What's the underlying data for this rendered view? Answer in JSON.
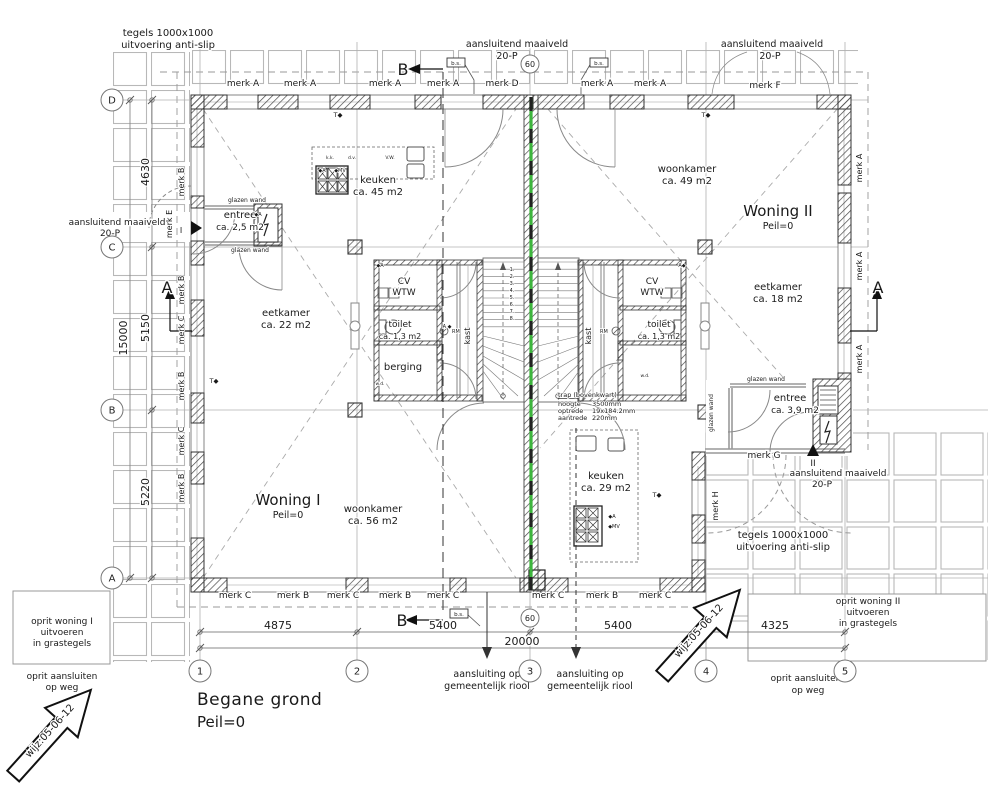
{
  "drawing": {
    "title": "Begane grond",
    "subtitle": "Peil=0"
  },
  "colors": {
    "text": "#1a1a1a",
    "wall": "#555555",
    "hatch": "#4a4a4a",
    "grid": "#b0b0b0",
    "tile": "#b8b8b8",
    "dash": "#999999",
    "green": "#3db53d",
    "thin": "#777777"
  },
  "grid": {
    "columns": [
      {
        "label": "1",
        "x": 200
      },
      {
        "label": "2",
        "x": 357
      },
      {
        "label": "3",
        "x": 530
      },
      {
        "label": "4",
        "x": 706
      },
      {
        "label": "5",
        "x": 845
      }
    ],
    "columns_y": 671,
    "rows": [
      {
        "label": "D",
        "y": 100
      },
      {
        "label": "C",
        "y": 247
      },
      {
        "label": "B",
        "y": 410
      },
      {
        "label": "A",
        "y": 578
      }
    ],
    "rows_x": 112,
    "small_bubbles": [
      {
        "label": "60",
        "x": 530,
        "y": 64
      },
      {
        "label": "60",
        "x": 530,
        "y": 618
      }
    ],
    "bs_tags": [
      {
        "label": "b.s.",
        "x": 456,
        "y": 63
      },
      {
        "label": "b.s.",
        "x": 599,
        "y": 63
      },
      {
        "label": "b.s.",
        "x": 459,
        "y": 614
      }
    ]
  },
  "dimensions": {
    "bottom": [
      {
        "t": "4875",
        "x": 278,
        "y": 629
      },
      {
        "t": "5400",
        "x": 443,
        "y": 629
      },
      {
        "t": "5400",
        "x": 618,
        "y": 629
      },
      {
        "t": "4325",
        "x": 775,
        "y": 629
      }
    ],
    "bottom_total": {
      "t": "20000",
      "x": 522,
      "y": 645
    },
    "left": [
      {
        "t": "4630",
        "x": 149,
        "y": 172
      },
      {
        "t": "5150",
        "x": 149,
        "y": 328
      },
      {
        "t": "5220",
        "x": 149,
        "y": 492
      }
    ],
    "left_total": {
      "t": "15000",
      "x": 127,
      "y": 338
    }
  },
  "annotations": [
    {
      "t": "tegels 1000x1000",
      "x": 168,
      "y": 36,
      "s": 10
    },
    {
      "t": "uitvoering anti-slip",
      "x": 168,
      "y": 48,
      "s": 10
    },
    {
      "t": "aansluitend maaiveld",
      "x": 517,
      "y": 47,
      "s": 9.5
    },
    {
      "t": "20-P",
      "x": 507,
      "y": 59,
      "s": 9.5
    },
    {
      "t": "aansluitend maaiveld",
      "x": 772,
      "y": 47,
      "s": 9.5
    },
    {
      "t": "20-P",
      "x": 770,
      "y": 59,
      "s": 9.5
    },
    {
      "t": "B",
      "x": 403,
      "y": 75,
      "s": 16
    },
    {
      "t": "B",
      "x": 402,
      "y": 626,
      "s": 16
    },
    {
      "t": "A",
      "x": 167,
      "y": 293,
      "s": 16
    },
    {
      "t": "A",
      "x": 878,
      "y": 293,
      "s": 16
    },
    {
      "t": "merk A",
      "x": 243,
      "y": 86,
      "s": 9
    },
    {
      "t": "merk A",
      "x": 300,
      "y": 86,
      "s": 9
    },
    {
      "t": "merk A",
      "x": 385,
      "y": 86,
      "s": 9
    },
    {
      "t": "merk A",
      "x": 443,
      "y": 86,
      "s": 9
    },
    {
      "t": "merk D",
      "x": 502,
      "y": 86,
      "s": 9
    },
    {
      "t": "merk A",
      "x": 597,
      "y": 86,
      "s": 9
    },
    {
      "t": "merk A",
      "x": 650,
      "y": 86,
      "s": 9
    },
    {
      "t": "merk F",
      "x": 765,
      "y": 88,
      "s": 9
    },
    {
      "t": "T◆",
      "x": 338,
      "y": 117,
      "s": 6.5
    },
    {
      "t": "T◆",
      "x": 706,
      "y": 117,
      "s": 6.5
    },
    {
      "t": "T◆",
      "x": 214,
      "y": 383,
      "s": 6.5
    },
    {
      "t": "T◆",
      "x": 657,
      "y": 497,
      "s": 6.5
    },
    {
      "t": "woonkamer",
      "x": 687,
      "y": 172,
      "s": 10
    },
    {
      "t": "ca. 49 m2",
      "x": 687,
      "y": 184,
      "s": 10
    },
    {
      "t": "keuken",
      "x": 378,
      "y": 183,
      "s": 10
    },
    {
      "t": "ca. 45 m2",
      "x": 378,
      "y": 195,
      "s": 10
    },
    {
      "t": "Woning II",
      "x": 778,
      "y": 216,
      "s": 15
    },
    {
      "t": "Peil=0",
      "x": 778,
      "y": 229,
      "s": 9.5
    },
    {
      "t": "Woning I",
      "x": 288,
      "y": 505,
      "s": 15
    },
    {
      "t": "Peil=0",
      "x": 288,
      "y": 518,
      "s": 9.5
    },
    {
      "t": "aansluitend maaiveld",
      "x": 117,
      "y": 225,
      "s": 9
    },
    {
      "t": "20-P",
      "x": 110,
      "y": 236,
      "s": 9
    },
    {
      "t": "merk E",
      "x": 172,
      "y": 224,
      "s": 8,
      "r": -90
    },
    {
      "t": "I",
      "x": 181,
      "y": 233,
      "s": 8
    },
    {
      "t": "glazen wand",
      "x": 247,
      "y": 202,
      "s": 6
    },
    {
      "t": "glazen wand",
      "x": 250,
      "y": 252,
      "s": 6
    },
    {
      "t": "entree",
      "x": 240,
      "y": 218,
      "s": 10
    },
    {
      "t": "ca. 2,5 m2",
      "x": 240,
      "y": 230,
      "s": 9
    },
    {
      "t": "merk B",
      "x": 184,
      "y": 182,
      "s": 8,
      "r": -90
    },
    {
      "t": "merk B",
      "x": 184,
      "y": 290,
      "s": 8,
      "r": -90
    },
    {
      "t": "merk C",
      "x": 184,
      "y": 330,
      "s": 8,
      "r": -90
    },
    {
      "t": "merk B",
      "x": 184,
      "y": 386,
      "s": 8,
      "r": -90
    },
    {
      "t": "merk C",
      "x": 184,
      "y": 441,
      "s": 8,
      "r": -90
    },
    {
      "t": "merk B",
      "x": 184,
      "y": 488,
      "s": 8,
      "r": -90
    },
    {
      "t": "eetkamer",
      "x": 286,
      "y": 316,
      "s": 10
    },
    {
      "t": "ca. 22 m2",
      "x": 286,
      "y": 328,
      "s": 10
    },
    {
      "t": "CV",
      "x": 404,
      "y": 284,
      "s": 9
    },
    {
      "t": "WTW",
      "x": 404,
      "y": 295,
      "s": 9
    },
    {
      "t": "toilet",
      "x": 400,
      "y": 327,
      "s": 9
    },
    {
      "t": "ca. 1,3 m2",
      "x": 400,
      "y": 339,
      "s": 8
    },
    {
      "t": "berging",
      "x": 403,
      "y": 370,
      "s": 10
    },
    {
      "t": "kast",
      "x": 470,
      "y": 336,
      "s": 8,
      "r": -90
    },
    {
      "t": "kast",
      "x": 591,
      "y": 336,
      "s": 8,
      "r": -90
    },
    {
      "t": "CV",
      "x": 652,
      "y": 284,
      "s": 9
    },
    {
      "t": "WTW",
      "x": 652,
      "y": 295,
      "s": 9
    },
    {
      "t": "toilet",
      "x": 659,
      "y": 327,
      "s": 9
    },
    {
      "t": "ca. 1,3 m2",
      "x": 659,
      "y": 339,
      "s": 8
    },
    {
      "t": "RM",
      "x": 452,
      "y": 333,
      "s": 5,
      "a": "start"
    },
    {
      "t": "RM",
      "x": 600,
      "y": 333,
      "s": 5,
      "a": "start"
    },
    {
      "t": "1.",
      "x": 512,
      "y": 271,
      "s": 5
    },
    {
      "t": "2.",
      "x": 512,
      "y": 278,
      "s": 5
    },
    {
      "t": "3.",
      "x": 512,
      "y": 285,
      "s": 5
    },
    {
      "t": "4.",
      "x": 512,
      "y": 292,
      "s": 5
    },
    {
      "t": "5.",
      "x": 512,
      "y": 299,
      "s": 5
    },
    {
      "t": "6.",
      "x": 512,
      "y": 306,
      "s": 5
    },
    {
      "t": "7.",
      "x": 512,
      "y": 313,
      "s": 5
    },
    {
      "t": "8.",
      "x": 512,
      "y": 320,
      "s": 5
    },
    {
      "t": "trap (bovenkwart)",
      "x": 558,
      "y": 397,
      "s": 6.5,
      "a": "start"
    },
    {
      "t": "hoogte",
      "x": 558,
      "y": 406,
      "s": 6.5,
      "a": "start"
    },
    {
      "t": "3500mm",
      "x": 592,
      "y": 406,
      "s": 6.5,
      "a": "start"
    },
    {
      "t": "optrede",
      "x": 558,
      "y": 413,
      "s": 6.5,
      "a": "start"
    },
    {
      "t": "19x184.2mm",
      "x": 592,
      "y": 413,
      "s": 6.5,
      "a": "start"
    },
    {
      "t": "aantrede",
      "x": 558,
      "y": 420,
      "s": 6.5,
      "a": "start"
    },
    {
      "t": "220mm",
      "x": 592,
      "y": 420,
      "s": 6.5,
      "a": "start"
    },
    {
      "t": "eetkamer",
      "x": 778,
      "y": 290,
      "s": 10
    },
    {
      "t": "ca. 18 m2",
      "x": 778,
      "y": 302,
      "s": 10
    },
    {
      "t": "merk A",
      "x": 862,
      "y": 168,
      "s": 8,
      "r": -90
    },
    {
      "t": "merk A",
      "x": 862,
      "y": 266,
      "s": 8,
      "r": -90
    },
    {
      "t": "merk A",
      "x": 862,
      "y": 359,
      "s": 8,
      "r": -90
    },
    {
      "t": "woonkamer",
      "x": 373,
      "y": 512,
      "s": 10
    },
    {
      "t": "ca. 56 m2",
      "x": 373,
      "y": 524,
      "s": 10
    },
    {
      "t": "keuken",
      "x": 606,
      "y": 479,
      "s": 10
    },
    {
      "t": "ca. 29 m2",
      "x": 606,
      "y": 491,
      "s": 10
    },
    {
      "t": "glazen wand",
      "x": 766,
      "y": 381,
      "s": 6
    },
    {
      "t": "glazen wand",
      "x": 713,
      "y": 413,
      "s": 6,
      "r": -90
    },
    {
      "t": "entree",
      "x": 790,
      "y": 401,
      "s": 10
    },
    {
      "t": "ca. 3,9 m2",
      "x": 795,
      "y": 413,
      "s": 9
    },
    {
      "t": "merk G",
      "x": 764,
      "y": 458,
      "s": 9
    },
    {
      "t": "II",
      "x": 813,
      "y": 466,
      "s": 9
    },
    {
      "t": "aansluitend maaiveld",
      "x": 838,
      "y": 476,
      "s": 9
    },
    {
      "t": "20-P",
      "x": 822,
      "y": 487,
      "s": 9
    },
    {
      "t": "merk H",
      "x": 718,
      "y": 506,
      "s": 8,
      "r": -90
    },
    {
      "t": "tegels 1000x1000",
      "x": 783,
      "y": 538,
      "s": 10
    },
    {
      "t": "uitvoering anti-slip",
      "x": 783,
      "y": 550,
      "s": 10
    },
    {
      "t": "merk C",
      "x": 235,
      "y": 598,
      "s": 9
    },
    {
      "t": "merk B",
      "x": 293,
      "y": 598,
      "s": 9
    },
    {
      "t": "merk C",
      "x": 343,
      "y": 598,
      "s": 9
    },
    {
      "t": "merk B",
      "x": 395,
      "y": 598,
      "s": 9
    },
    {
      "t": "merk C",
      "x": 443,
      "y": 598,
      "s": 9
    },
    {
      "t": "merk C",
      "x": 548,
      "y": 598,
      "s": 9
    },
    {
      "t": "merk B",
      "x": 602,
      "y": 598,
      "s": 9
    },
    {
      "t": "merk C",
      "x": 655,
      "y": 598,
      "s": 9
    },
    {
      "t": "aansluiting op",
      "x": 487,
      "y": 677,
      "s": 9.5
    },
    {
      "t": "gemeentelijk riool",
      "x": 487,
      "y": 689,
      "s": 9.5
    },
    {
      "t": "aansluiting op",
      "x": 590,
      "y": 677,
      "s": 9.5
    },
    {
      "t": "gemeentelijk riool",
      "x": 590,
      "y": 689,
      "s": 9.5
    },
    {
      "t": "oprit woning I",
      "x": 62,
      "y": 624,
      "s": 9
    },
    {
      "t": "uitvoeren",
      "x": 62,
      "y": 635,
      "s": 9
    },
    {
      "t": "in grastegels",
      "x": 62,
      "y": 646,
      "s": 9
    },
    {
      "t": "oprit aansluiten",
      "x": 62,
      "y": 679,
      "s": 9
    },
    {
      "t": "op weg",
      "x": 62,
      "y": 690,
      "s": 9
    },
    {
      "t": "oprit woning II",
      "x": 868,
      "y": 604,
      "s": 9
    },
    {
      "t": "uitvoeren",
      "x": 868,
      "y": 615,
      "s": 9
    },
    {
      "t": "in grastegels",
      "x": 868,
      "y": 626,
      "s": 9
    },
    {
      "t": "oprit aansluiten",
      "x": 806,
      "y": 681,
      "s": 9
    },
    {
      "t": "op weg",
      "x": 808,
      "y": 693,
      "s": 9
    },
    {
      "t": "wijz:05-06-12",
      "x": 52,
      "y": 733,
      "s": 10,
      "r": -48
    },
    {
      "t": "wijz:05-06-12",
      "x": 701,
      "y": 633,
      "s": 10,
      "r": -48
    },
    {
      "t": "k.k.",
      "x": 330,
      "y": 159,
      "s": 4.5
    },
    {
      "t": "d.v.",
      "x": 352,
      "y": 159,
      "s": 4.5
    },
    {
      "t": "V.W.",
      "x": 390,
      "y": 159,
      "s": 4.5
    },
    {
      "t": "◆A",
      "x": 322,
      "y": 172,
      "s": 5
    },
    {
      "t": "◆MV",
      "x": 340,
      "y": 172,
      "s": 5
    },
    {
      "t": "◆A",
      "x": 258,
      "y": 216,
      "s": 5
    },
    {
      "t": "A ◆",
      "x": 447,
      "y": 328,
      "s": 5
    },
    {
      "t": "◆A",
      "x": 612,
      "y": 518,
      "s": 5
    },
    {
      "t": "◆MV",
      "x": 614,
      "y": 528,
      "s": 5
    },
    {
      "t": "A◆",
      "x": 682,
      "y": 267,
      "s": 5
    },
    {
      "t": "◆A",
      "x": 380,
      "y": 267,
      "s": 5
    },
    {
      "t": "w.d.",
      "x": 380,
      "y": 385,
      "s": 4.5
    },
    {
      "t": "w.d.",
      "x": 645,
      "y": 377,
      "s": 4.5
    }
  ]
}
